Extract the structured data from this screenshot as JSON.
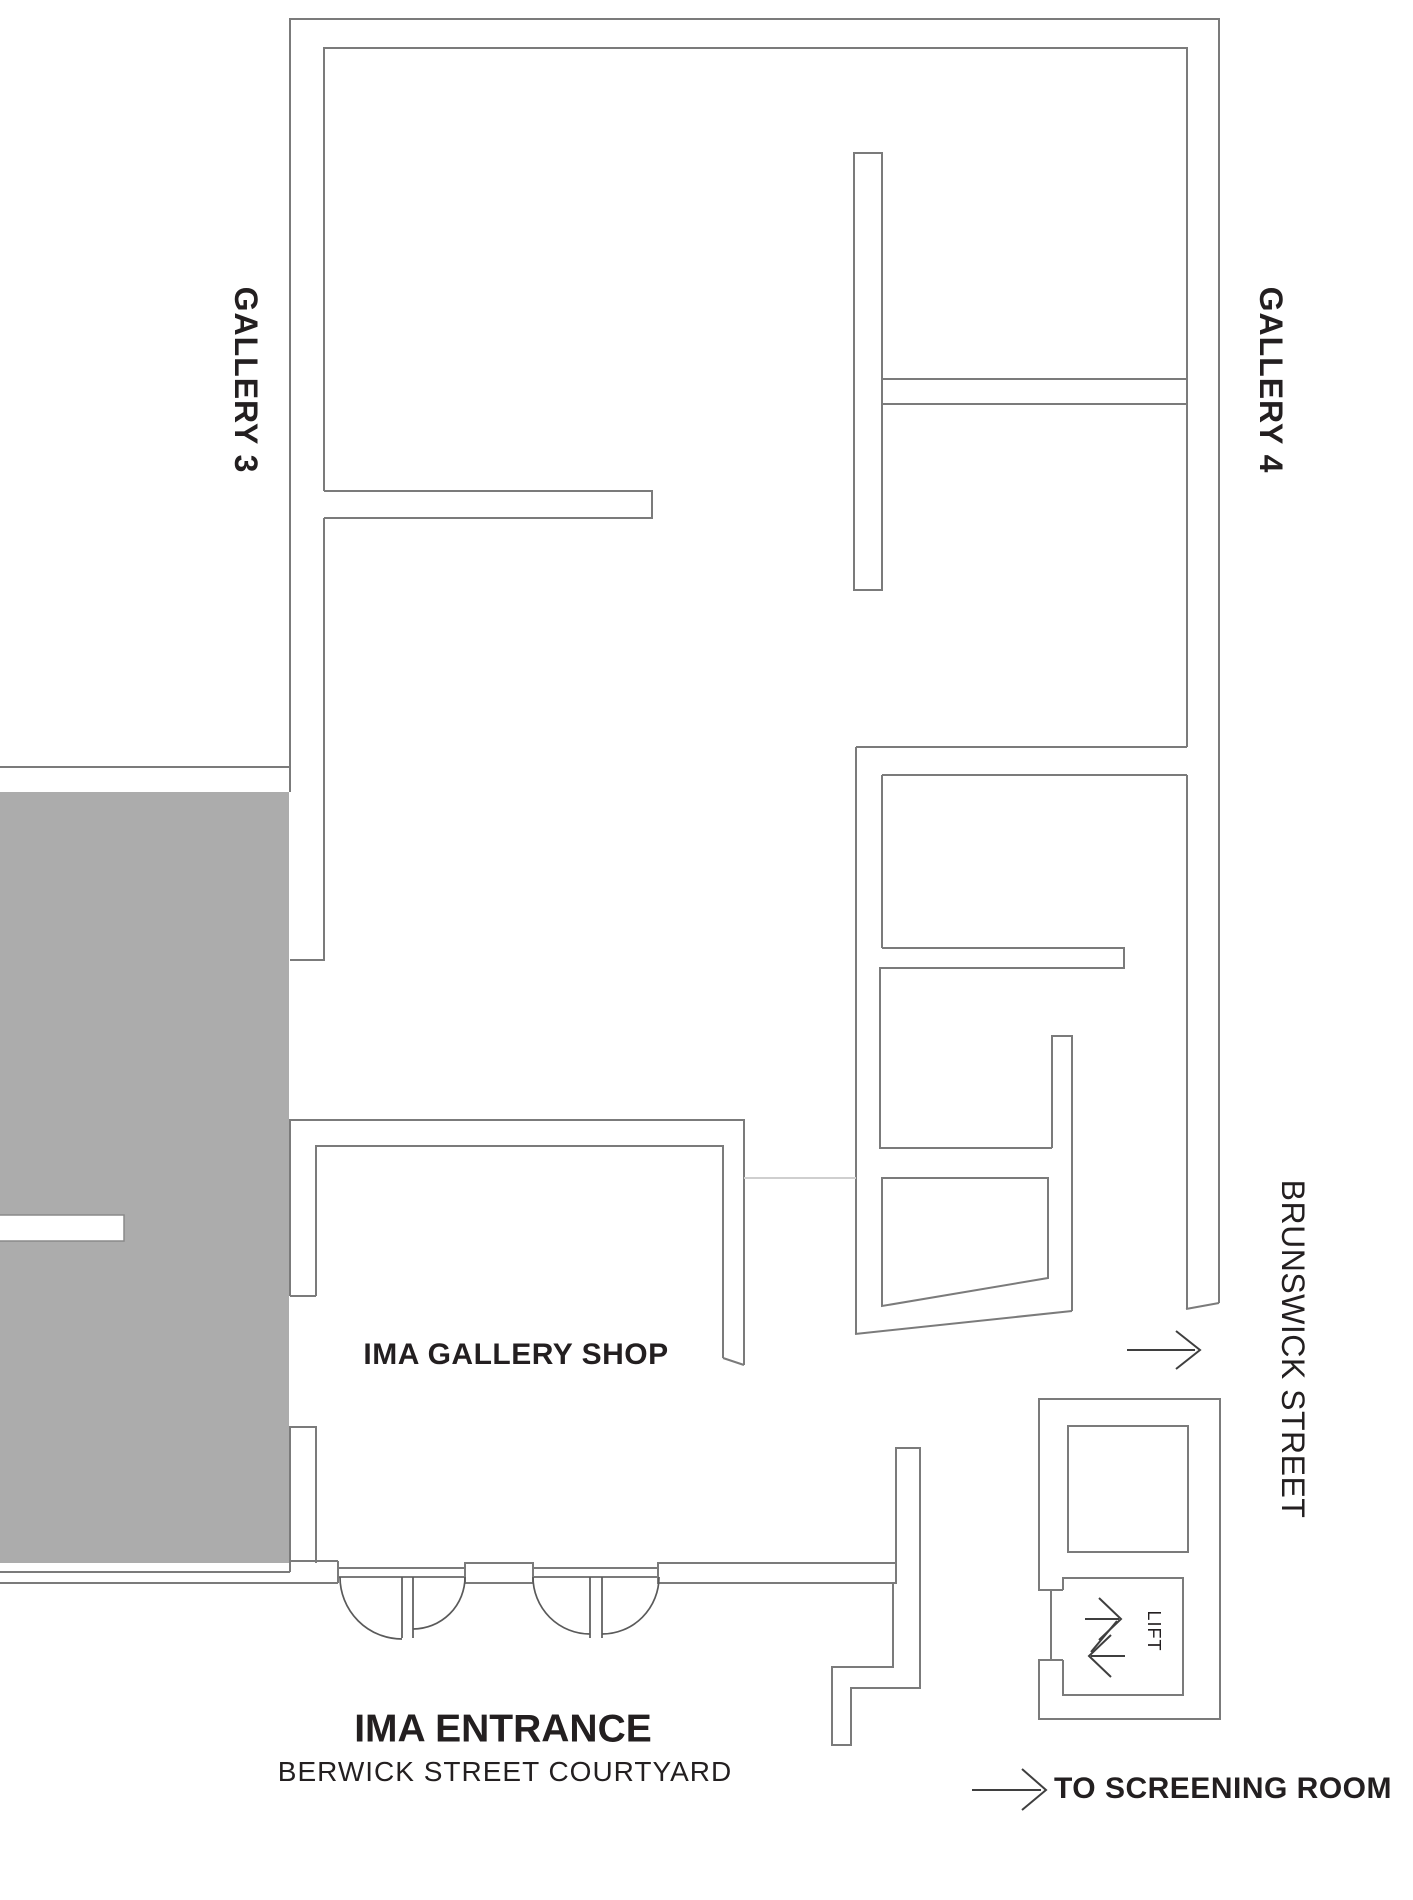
{
  "floorplan": {
    "rooms": {
      "gallery3": {
        "label": "GALLERY 3"
      },
      "gallery4": {
        "label": "GALLERY 4"
      },
      "shop": {
        "label": "IMA GALLERY SHOP"
      },
      "lift": {
        "label": "LIFT"
      }
    },
    "entrance": {
      "title": "IMA ENTRANCE",
      "subtitle": "BERWICK STREET COURTYARD"
    },
    "street": {
      "label": "BRUNSWICK STREET"
    },
    "wayfinding": {
      "screening": "TO SCREENING ROOM"
    },
    "colors": {
      "wall_line": "#7b7b7b",
      "door_line": "#5a5a5a",
      "text": "#231f20",
      "solid_block": "#acacac",
      "faint_line": "#cfcfcf",
      "arrow": "#3f3f3f"
    }
  }
}
